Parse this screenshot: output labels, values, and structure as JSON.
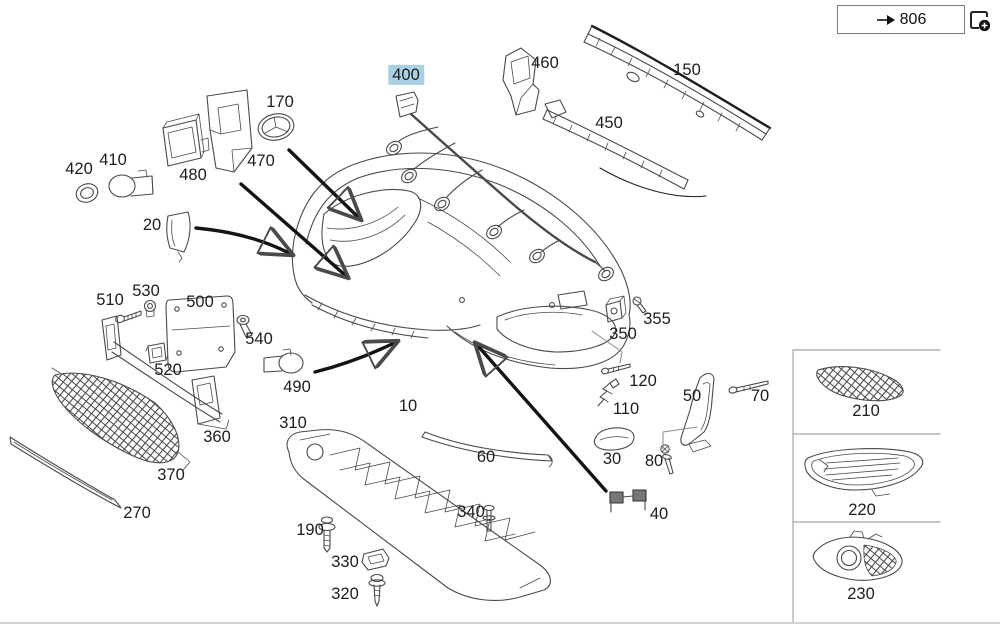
{
  "header": {
    "reference": {
      "label": "806",
      "icon": "jump-arrow-icon"
    },
    "add_icon": "page-add-icon"
  },
  "colors": {
    "highlight": "#a9d0e3",
    "line_art": "#4a4a4a",
    "arrow": "#141414",
    "frame": "#b3b3b3"
  },
  "parts": [
    {
      "label": "400",
      "x": 406,
      "y": 75,
      "highlighted": true
    },
    {
      "label": "460",
      "x": 545,
      "y": 63,
      "highlighted": false
    },
    {
      "label": "150",
      "x": 687,
      "y": 70,
      "highlighted": false
    },
    {
      "label": "450",
      "x": 609,
      "y": 123,
      "highlighted": false
    },
    {
      "label": "170",
      "x": 280,
      "y": 102,
      "highlighted": false
    },
    {
      "label": "470",
      "x": 261,
      "y": 161,
      "highlighted": false
    },
    {
      "label": "480",
      "x": 193,
      "y": 175,
      "highlighted": false
    },
    {
      "label": "410",
      "x": 113,
      "y": 160,
      "highlighted": false
    },
    {
      "label": "420",
      "x": 79,
      "y": 169,
      "highlighted": false
    },
    {
      "label": "20",
      "x": 152,
      "y": 225,
      "highlighted": false
    },
    {
      "label": "510",
      "x": 110,
      "y": 300,
      "highlighted": false
    },
    {
      "label": "530",
      "x": 146,
      "y": 291,
      "highlighted": false
    },
    {
      "label": "500",
      "x": 200,
      "y": 302,
      "highlighted": false
    },
    {
      "label": "540",
      "x": 259,
      "y": 339,
      "highlighted": false
    },
    {
      "label": "520",
      "x": 168,
      "y": 370,
      "highlighted": false
    },
    {
      "label": "360",
      "x": 217,
      "y": 437,
      "highlighted": false
    },
    {
      "label": "370",
      "x": 171,
      "y": 475,
      "highlighted": false
    },
    {
      "label": "270",
      "x": 137,
      "y": 513,
      "highlighted": false
    },
    {
      "label": "490",
      "x": 297,
      "y": 387,
      "highlighted": false
    },
    {
      "label": "10",
      "x": 408,
      "y": 406,
      "highlighted": false
    },
    {
      "label": "310",
      "x": 293,
      "y": 423,
      "highlighted": false
    },
    {
      "label": "190",
      "x": 310,
      "y": 530,
      "highlighted": false
    },
    {
      "label": "330",
      "x": 345,
      "y": 562,
      "highlighted": false
    },
    {
      "label": "320",
      "x": 345,
      "y": 594,
      "highlighted": false
    },
    {
      "label": "340",
      "x": 471,
      "y": 512,
      "highlighted": false
    },
    {
      "label": "60",
      "x": 486,
      "y": 457,
      "highlighted": false
    },
    {
      "label": "30",
      "x": 612,
      "y": 459,
      "highlighted": false
    },
    {
      "label": "80",
      "x": 654,
      "y": 461,
      "highlighted": false
    },
    {
      "label": "40",
      "x": 659,
      "y": 514,
      "highlighted": false
    },
    {
      "label": "110",
      "x": 626,
      "y": 409,
      "highlighted": false
    },
    {
      "label": "120",
      "x": 643,
      "y": 381,
      "highlighted": false
    },
    {
      "label": "350",
      "x": 623,
      "y": 334,
      "highlighted": false
    },
    {
      "label": "355",
      "x": 657,
      "y": 319,
      "highlighted": false
    },
    {
      "label": "50",
      "x": 692,
      "y": 396,
      "highlighted": false
    },
    {
      "label": "70",
      "x": 760,
      "y": 396,
      "highlighted": false
    },
    {
      "label": "210",
      "x": 866,
      "y": 411,
      "highlighted": false
    },
    {
      "label": "220",
      "x": 862,
      "y": 510,
      "highlighted": false
    },
    {
      "label": "230",
      "x": 861,
      "y": 594,
      "highlighted": false
    }
  ]
}
